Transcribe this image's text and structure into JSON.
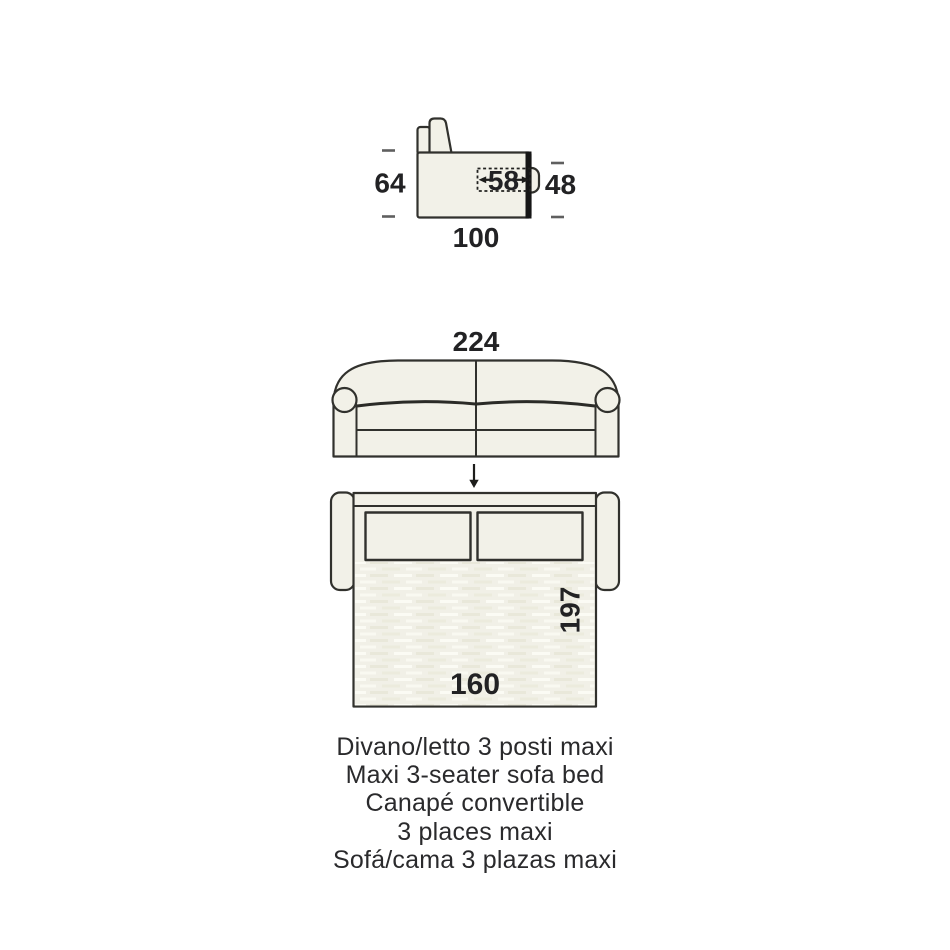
{
  "dimensions": {
    "side_view": {
      "overall_height": "64",
      "seat_depth": "58",
      "seat_height": "48",
      "overall_depth": "100"
    },
    "front_view": {
      "overall_width": "224"
    },
    "bed_view": {
      "mattress_length": "197",
      "mattress_width": "160"
    }
  },
  "caption": {
    "lines": [
      "Divano/letto 3 posti maxi",
      "Maxi 3-seater sofa bed",
      "Canapé convertible",
      "3 places maxi",
      "Sofá/cama 3 plazas maxi"
    ]
  },
  "colors": {
    "upholstery_fill": "#f2f1e8",
    "outline_stroke": "#31312d",
    "text": "#2a2a2c",
    "background": "#ffffff"
  }
}
